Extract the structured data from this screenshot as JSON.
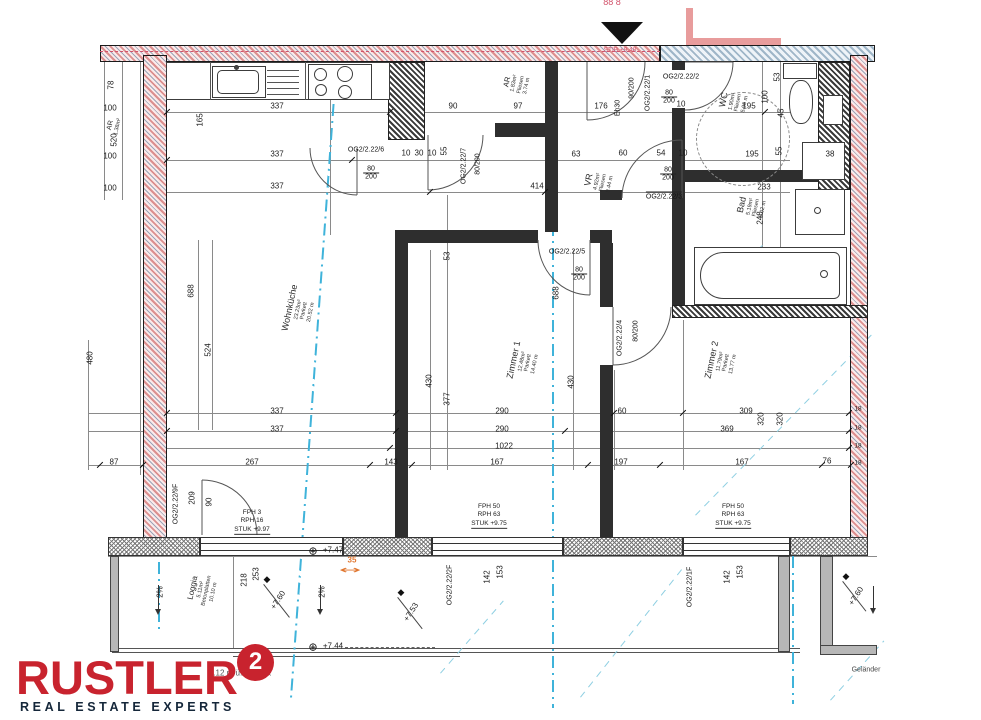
{
  "logo": {
    "brand": "RUSTLER",
    "sup": "2",
    "tagline": "REAL ESTATE EXPERTS"
  },
  "plan": {
    "north_clip": "88 8",
    "stair_level": "STIB +9.48",
    "eh30": "Eh30",
    "ffbok_note": "1.12 m ü. FFBOK",
    "gelaender": "Geländer",
    "offset": "35"
  },
  "rooms": {
    "wohnkueche": {
      "name": "Wohnküche",
      "area": "23.23m²",
      "floor": "Parkett",
      "len": "20.52 m"
    },
    "zimmer1": {
      "name": "Zimmer 1",
      "area": "12.48m²",
      "floor": "Parkett",
      "len": "14.40 m"
    },
    "zimmer2": {
      "name": "Zimmer 2",
      "area": "11.79m²",
      "floor": "Parkett",
      "len": "13.77 m"
    },
    "bad": {
      "name": "Bad",
      "area": "5.19m²",
      "floor": "Fliesen",
      "len": "9.02 m"
    },
    "wc": {
      "name": "WC",
      "area": "1.90m²",
      "floor": "Fliesen",
      "len": "5.90 m"
    },
    "vr": {
      "name": "VR",
      "area": "4.92m²",
      "floor": "Fliesen",
      "len": "9.44 m"
    },
    "ar": {
      "name": "AR",
      "area": "1.83m²",
      "floor": "Fliesen",
      "len": "3.74 m"
    },
    "ar2": {
      "name": "AR",
      "area": "1.38m²"
    },
    "loggia": {
      "name": "Loggia",
      "area": "5.11m²",
      "floor": "Betonplatten",
      "len": "10.10 m"
    }
  },
  "doors": {
    "d1": {
      "id": "OG2/2.22/1",
      "size": "90/200"
    },
    "d2": {
      "id": "OG2/2.22/2",
      "w": "80",
      "h": "200"
    },
    "d3": {
      "id": "OG2/2.22/3",
      "w": "80",
      "h": "200"
    },
    "d4": {
      "id": "OG2/2.22/4",
      "size": "80/200"
    },
    "d5": {
      "id": "OG2/2.22/5",
      "w": "80",
      "h": "200"
    },
    "d6": {
      "id": "OG2/2.22/6",
      "w": "80",
      "h": "200"
    },
    "d7": {
      "id": "OG2/2.22/7",
      "size": "80/200"
    },
    "d9": {
      "id": "OG2/2.22/9F"
    }
  },
  "windows": {
    "f1": {
      "id": "OG2/2.22/1F",
      "w": "153",
      "p": "142"
    },
    "f2": {
      "id": "OG2/2.22/2F",
      "w": "153",
      "p": "142"
    }
  },
  "fph": {
    "left": {
      "l1": "FPH 3",
      "l2": "RPH 16",
      "l3": "STUK +9.97"
    },
    "mid": {
      "l1": "FPH 50",
      "l2": "RPH 63",
      "l3": "STUK +9.75"
    },
    "right": {
      "l1": "FPH 50",
      "l2": "RPH 63",
      "l3": "STUK +9.75"
    }
  },
  "levels": {
    "a": "+7.47",
    "b": "+7.44",
    "c": "+7.60",
    "d": "+7.53",
    "e": "+7.60",
    "slope1": "2%",
    "slope2": "2%"
  },
  "dims": [
    "78",
    "100",
    "520",
    "100",
    "100",
    "165",
    "337",
    "337",
    "337",
    "90",
    "97",
    "176",
    "195",
    "53",
    "100",
    "45",
    "10",
    "30",
    "10",
    "55",
    "63",
    "60",
    "54",
    "10",
    "195",
    "55",
    "38",
    "414",
    "233",
    "248",
    "688",
    "524",
    "480",
    "53",
    "430",
    "377",
    "688",
    "430",
    "337",
    "337",
    "290",
    "290",
    "1022",
    "87",
    "267",
    "143",
    "167",
    "197",
    "167",
    "76",
    "60",
    "309",
    "369",
    "320",
    "320",
    "18",
    "18",
    "18",
    "18",
    "253",
    "218",
    "209",
    "90",
    "10"
  ],
  "colors": {
    "brand_red": "#c8232e",
    "tagline_navy": "#15273a",
    "wall_red": "#dc8f8f",
    "wall_blue": "#9fb6c8",
    "section_cyan": "#3fb3da",
    "marker_orange": "#e0762f"
  }
}
